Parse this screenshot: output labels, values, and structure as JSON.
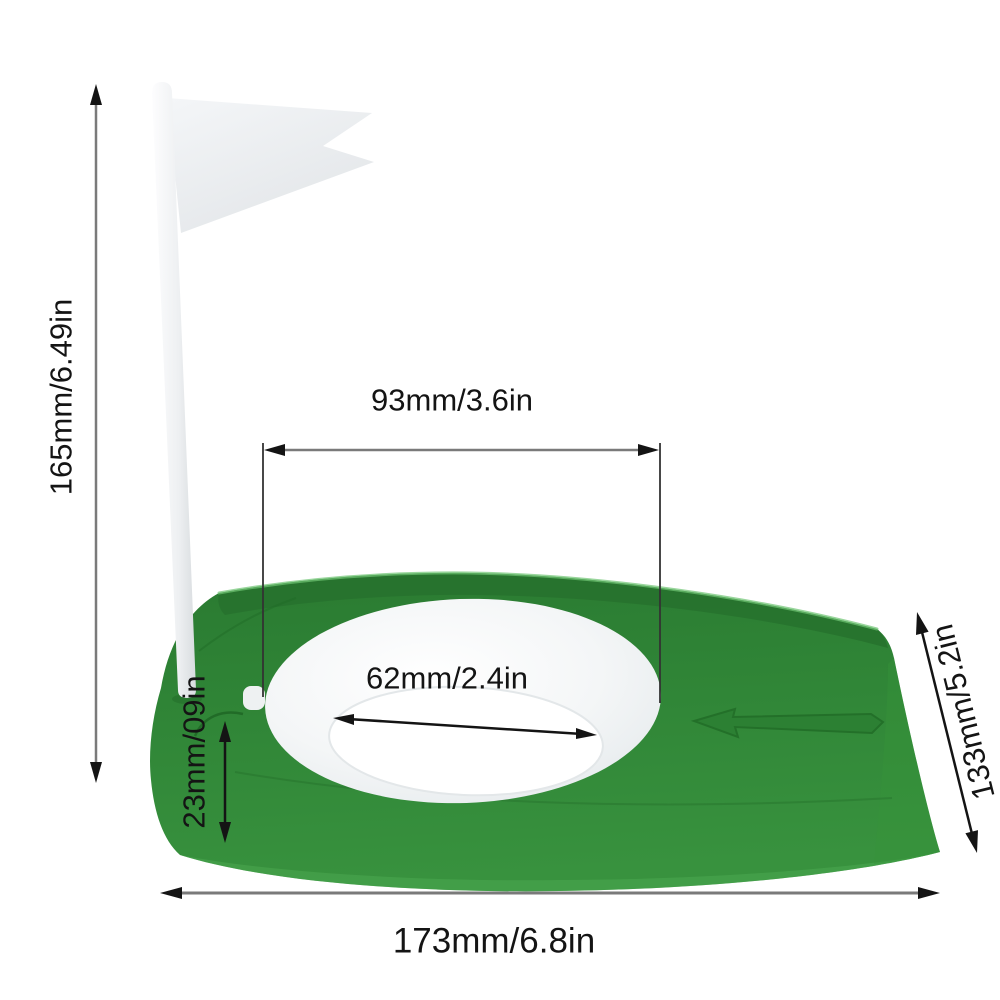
{
  "diagram": {
    "background": "#ffffff",
    "dimensions": {
      "flag_pole_height": "165mm/6.49in",
      "hole_center_width": "93mm/3.6in",
      "hole_diameter": "62mm/2.4in",
      "base_edge_height": "23mm/09in",
      "base_depth": "133mm/5.2in",
      "base_length": "173mm/6.8in"
    },
    "colors": {
      "base_green": "#2E8535",
      "base_green_dark": "#256D2C",
      "base_green_light": "#46A84D",
      "ring_white": "#F3F5F6",
      "hole_white": "#FFFFFF",
      "flag_white": "#EDEFF2",
      "pole_white": "#F4F6F7",
      "dim_line_gray": "#7A7A7A",
      "dim_text_black": "#141414"
    }
  }
}
